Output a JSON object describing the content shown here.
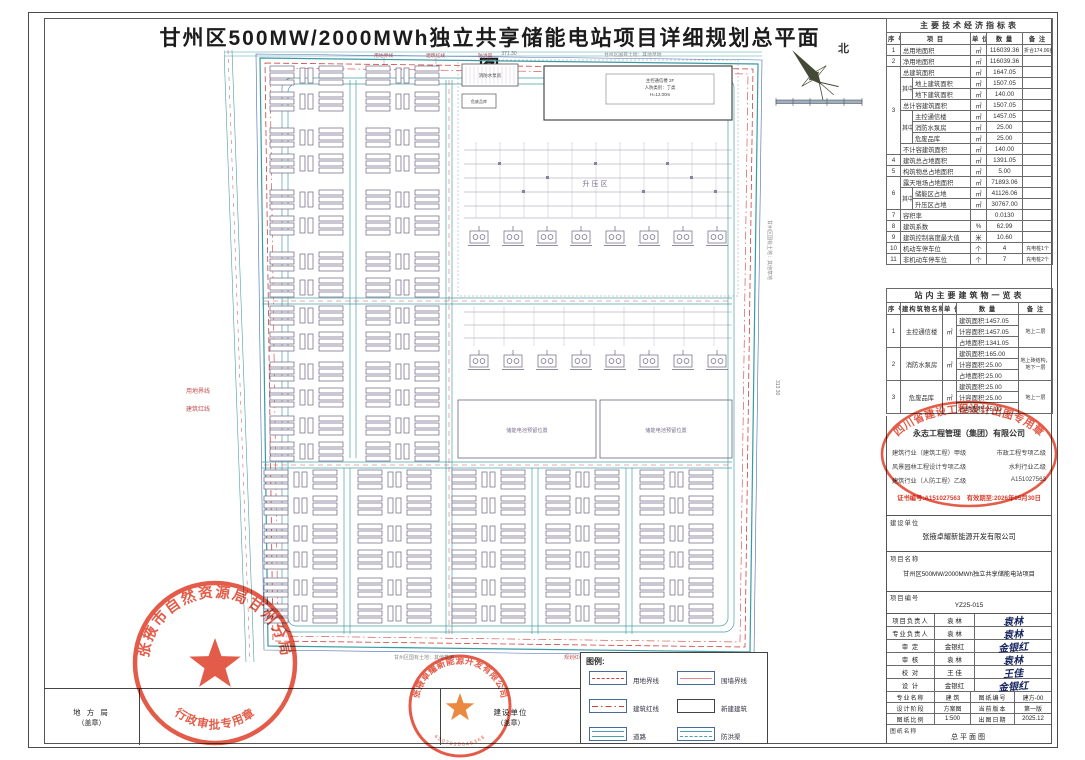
{
  "sheet": {
    "title": "甘州区500MW/2000MWh独立共享储能电站项目详细规划总平面图"
  },
  "compass": {
    "north": "北"
  },
  "plan": {
    "zone_label": "升压区",
    "building": {
      "l1": "主控通信楼 2F",
      "l2": "人防类别：丁类",
      "l3": "H=12.00m"
    },
    "fire_pump": "消防水泵房",
    "hazard_store": "危废品库",
    "reserved_1": "储能电池预留位置",
    "reserved_2": "储能电池预留位置",
    "notes": {
      "top": "甘州区国有土地：其他草地",
      "right": "甘州区国有土地：其他草地",
      "bottom": "甘州区国有土地：其他草地",
      "plan_red": "规划红线"
    },
    "boundary_labels": {
      "l1": "用地界线",
      "l2": "建筑红线",
      "l3": "防洪渠",
      "left1": "用地界线",
      "left2": "建筑红线"
    },
    "dims": {
      "top": "371.30",
      "right": "313.30"
    }
  },
  "indicators": {
    "title": "主要技术经济指标表",
    "headers": {
      "no": "序 号",
      "item": "项  目",
      "unit": "单 位",
      "qty": "数  量",
      "note": "备 注"
    },
    "zhong": "其中",
    "r1": {
      "no": "1",
      "item": "总用地面积",
      "unit": "㎡",
      "qty": "116039.36",
      "note": "折合174.06亩"
    },
    "r2": {
      "no": "2",
      "item": "净用地面积",
      "unit": "㎡",
      "qty": "116039.36"
    },
    "r3": {
      "no": "3",
      "item": "总建筑面积",
      "unit": "㎡",
      "qty": "1647.05"
    },
    "r4": {
      "item": "地上建筑面积",
      "unit": "㎡",
      "qty": "1507.05"
    },
    "r5": {
      "item": "地下建筑面积",
      "unit": "㎡",
      "qty": "140.00"
    },
    "r6": {
      "item": "总计容建筑面积",
      "unit": "㎡",
      "qty": "1507.05"
    },
    "r7": {
      "item": "主控通信楼",
      "unit": "㎡",
      "qty": "1457.05"
    },
    "r8": {
      "item": "消防水泵房",
      "unit": "㎡",
      "qty": "25.00"
    },
    "r9": {
      "item": "危废品库",
      "unit": "㎡",
      "qty": "25.00"
    },
    "r10": {
      "item": "不计容建筑面积",
      "unit": "㎡",
      "qty": "140.00"
    },
    "r11": {
      "no": "4",
      "item": "建筑总占地面积",
      "unit": "㎡",
      "qty": "1391.05"
    },
    "r12": {
      "no": "5",
      "item": "构筑物总占地面积",
      "unit": "㎡",
      "qty": "5.00"
    },
    "r13": {
      "no": "6",
      "item": "露天堆场占地面积",
      "unit": "㎡",
      "qty": "71893.06"
    },
    "r14": {
      "item": "储能区占地",
      "unit": "㎡",
      "qty": "41126.06"
    },
    "r15": {
      "item": "升压区占地",
      "unit": "㎡",
      "qty": "30767.00"
    },
    "r16": {
      "no": "7",
      "item": "容积率",
      "unit": "",
      "qty": "0.0130"
    },
    "r17": {
      "no": "8",
      "item": "建筑系数",
      "unit": "%",
      "qty": "62.99"
    },
    "r18": {
      "no": "9",
      "item": "建筑控制高度最大值",
      "unit": "米",
      "qty": "10.60"
    },
    "r19": {
      "no": "10",
      "item": "机动车停车位",
      "unit": "个",
      "qty": "4",
      "note": "充电桩1个"
    },
    "r20": {
      "no": "11",
      "item": "非机动车停车位",
      "unit": "个",
      "qty": "7",
      "note": "充电桩2个"
    }
  },
  "buildings": {
    "title": "站内主要建筑物一览表",
    "headers": {
      "no": "序 号",
      "name": "建构筑物名称",
      "unit": "单 位",
      "qty": "数  量",
      "note": "备  注"
    },
    "b1": {
      "no": "1",
      "name": "主控通信楼",
      "unit": "㎡",
      "q1": "建筑面积:1457.05",
      "q2": "计容面积:1457.05",
      "q3": "占地面积:1341.05",
      "note": "地上二层"
    },
    "b2": {
      "no": "2",
      "name": "消防水泵房",
      "unit": "㎡",
      "q1": "建筑面积:165.00",
      "q2": "计容面积:25.00",
      "q3": "占地面积:25.00",
      "note": "地上砖结构，地下一层"
    },
    "b3": {
      "no": "3",
      "name": "危废品库",
      "unit": "㎡",
      "q1": "建筑面积:25.00",
      "q2": "计容面积:25.00",
      "q3": "占地面积:25.00",
      "note": "地上一层"
    }
  },
  "firm": {
    "company": "永志工程管理（集团）有限公司",
    "q1a": "建筑行业（建筑工程）甲级",
    "q1b": "市政工程专项乙级",
    "q2a": "风景园林工程设计专项乙级",
    "q2b": "水利行业乙级",
    "q3a": "建筑行业（人防工程）乙级",
    "q3b": "A151027563",
    "stamp_oval": "四川省建设工程设计出图专用章",
    "cert_line": "证书编号:A151027563　有效期至:2026年05月30日"
  },
  "owner": {
    "label": "建设单位",
    "name": "张掖卓耀新能源开发有限公司"
  },
  "project": {
    "name_label": "项目名称",
    "name": "甘州区500MW/2000MWh独立共享储能电站项目",
    "no_label": "项目编号",
    "no": "YZ25-015"
  },
  "titleblock": {
    "pm_label": "项目负责人",
    "pm_name": "袁 林",
    "pm_sig": "袁林",
    "lead_label": "专业负责人",
    "lead_name": "袁 林",
    "lead_sig": "袁林",
    "approve_label": "审  定",
    "approve_name": "金银红",
    "approve_sig": "金银红",
    "review_label": "审  核",
    "review_name": "袁 林",
    "review_sig": "袁林",
    "check_label": "校  对",
    "check_name": "王 佳",
    "check_sig": "王佳",
    "design_label": "设  计",
    "design_name": "金银红",
    "design_sig": "金银红",
    "major_label": "专业名称",
    "major": "建 筑",
    "dwgno_label": "图纸编号",
    "dwgno": "建方-00",
    "stage_label": "设计阶段",
    "stage": "方案图",
    "ver_label": "当前版本",
    "ver": "第一版",
    "scale_label": "图纸比例",
    "scale": "1:500",
    "date_label": "出图日期",
    "date": "2025.12",
    "dwgname_label": "图纸名称",
    "dwgname": "总平面图"
  },
  "legend": {
    "title": "图例:",
    "i1": "用地界线",
    "i2": "围墙界线",
    "i3": "建筑红线",
    "i4": "新建建筑",
    "i5": "道路",
    "i6": "防洪渠"
  },
  "bottom": {
    "local_label": "地 方 局",
    "local_sub": "（盖章）",
    "owner_label": "建设单位",
    "owner_sub": "（盖章）"
  },
  "stamps": {
    "s1_top": "张掖市自然资源局甘州分局",
    "s1_bottom": "行政审批专用章",
    "s2_top": "张掖卓耀新能源开发有限公司",
    "s2_num": "6207020045368"
  },
  "colors": {
    "stamp": "#e0452f",
    "teal": "#4aa0a8",
    "red": "#cc4444",
    "ink": "#6b6280"
  }
}
